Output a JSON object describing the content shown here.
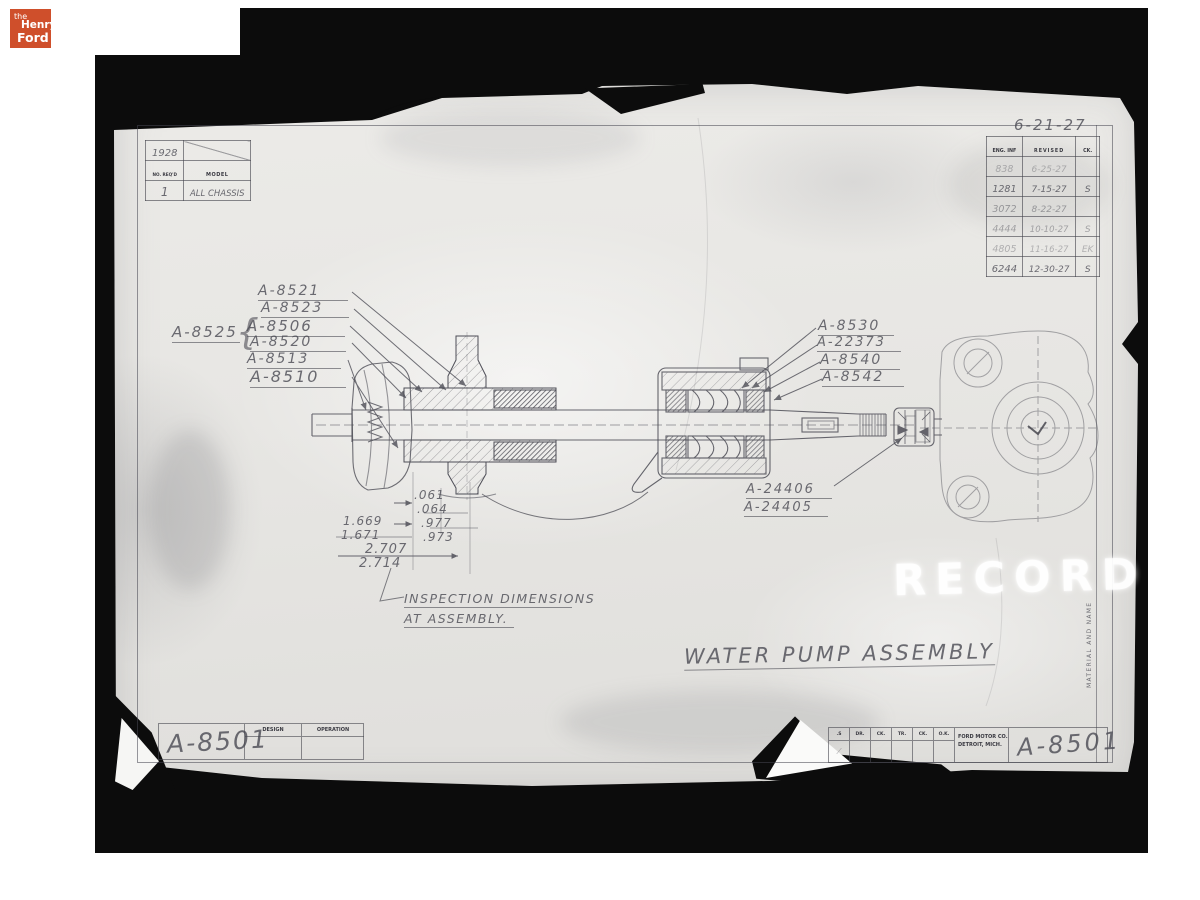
{
  "colors": {
    "logo_bg": "#cf4f2b",
    "mat": "#0c0c0c",
    "paper": "#e7e6e3",
    "pencil": "#4d4d56"
  },
  "logo": {
    "line1": "the",
    "line2": "Henry",
    "line3": "Ford"
  },
  "annotations": {
    "date_top": "6-21-27"
  },
  "model_table": {
    "year": "1928",
    "col1_header": "NO. REQ'D",
    "col2_header": "MODEL",
    "col1_value": "1",
    "col2_value": "ALL CHASSIS"
  },
  "revision_table": {
    "headers": [
      "ENG. INF",
      "REVISED",
      "CK."
    ],
    "rows": [
      [
        "838",
        "6-25-27",
        ""
      ],
      [
        "1281",
        "7-15-27",
        "S"
      ],
      [
        "3072",
        "8-22-27",
        ""
      ],
      [
        "4444",
        "10-10-27",
        "S"
      ],
      [
        "4805",
        "11-16-27",
        "EK"
      ],
      [
        "6244",
        "12-30-27",
        "S"
      ]
    ]
  },
  "part_labels": {
    "left": [
      "A-8521",
      "A-8523",
      "A-8506",
      "A-8520",
      "A-8513",
      "A-8510"
    ],
    "group": "A-8525",
    "brace": "{",
    "right": [
      "A-8530",
      "A-22373",
      "A-8540",
      "A-8542"
    ],
    "shaft_end": [
      "A-24406",
      "A-24405"
    ]
  },
  "dimensions": {
    "d1_top": ".061",
    "d1_bottom": ".064",
    "d2_top": ".977",
    "d2_bottom": ".973",
    "d3_top": "1.669",
    "d3_bottom": "1.671",
    "d4_top": "2.707",
    "d4_bottom": "2.714"
  },
  "notes": {
    "inspection_line1": "INSPECTION DIMENSIONS",
    "inspection_line2": "AT ASSEMBLY."
  },
  "title": {
    "text": "WATER PUMP ASSEMBLY"
  },
  "watermark": {
    "text": "RECORD"
  },
  "side_strip": {
    "label": "MATERIAL AND NAME"
  },
  "title_block_left": {
    "drawing_number": "A-8501",
    "design_label": "DESIGN",
    "operation_label": "OPERATION"
  },
  "title_block_right": {
    "cells": [
      ".S",
      "DR.",
      "CK.",
      "TR.",
      "CK.",
      "O.K."
    ],
    "company_line1": "FORD MOTOR CO.",
    "company_line2": "DETROIT, MICH.",
    "drawing_number": "A-8501"
  }
}
